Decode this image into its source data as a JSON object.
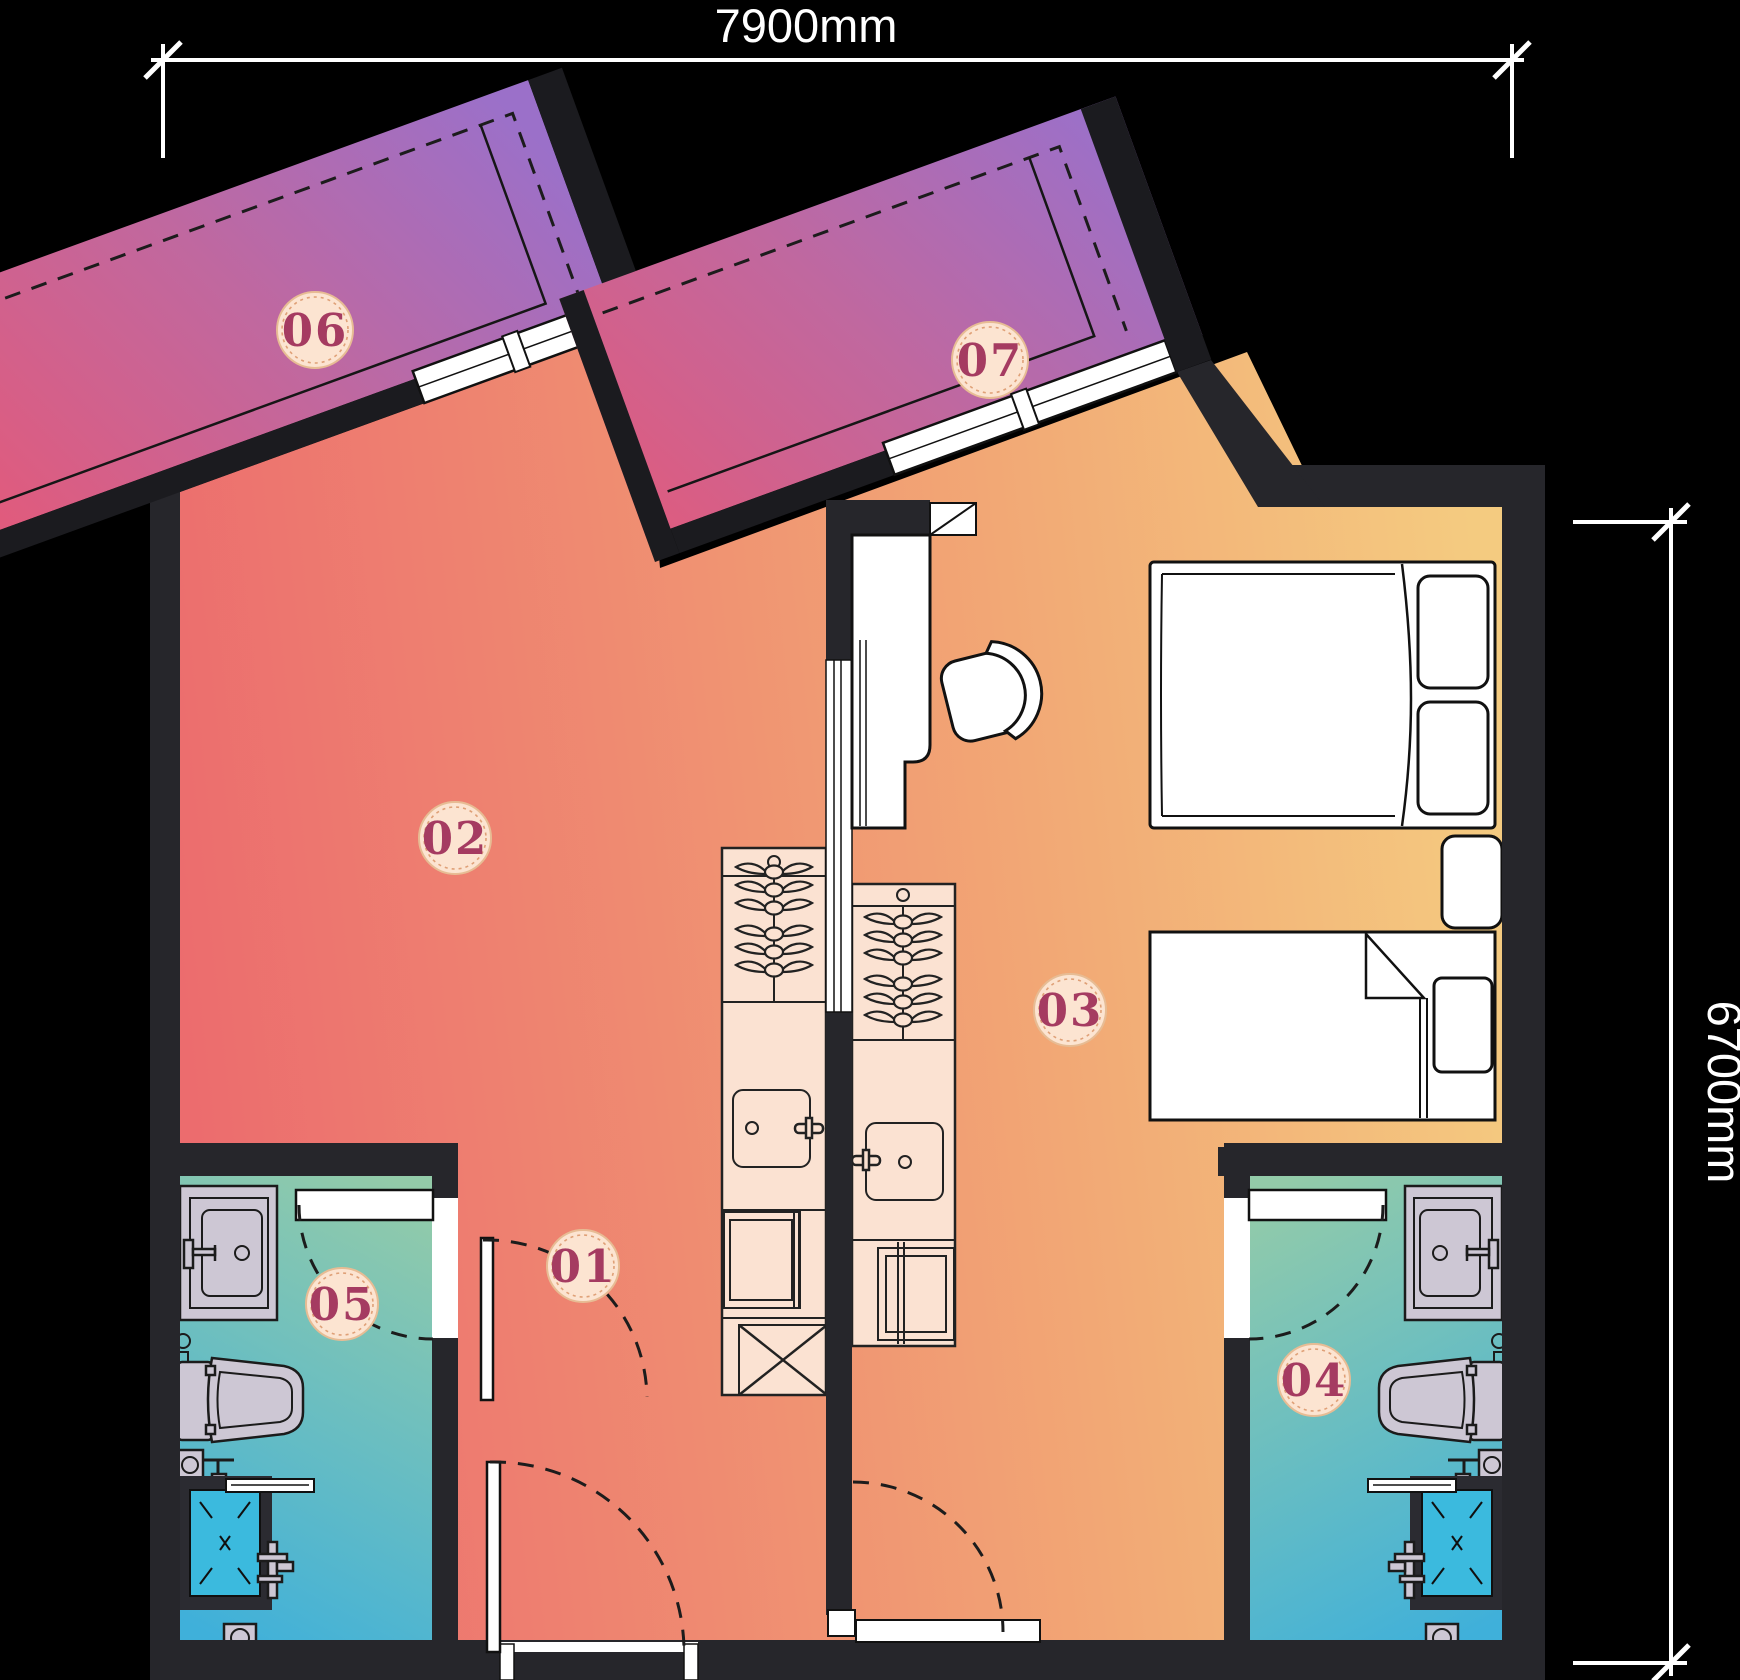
{
  "dimensions": {
    "width_label": "7900mm",
    "height_label": "6700mm"
  },
  "badges": [
    {
      "id": "01",
      "label": "01"
    },
    {
      "id": "02",
      "label": "02"
    },
    {
      "id": "03",
      "label": "03"
    },
    {
      "id": "04",
      "label": "04"
    },
    {
      "id": "05",
      "label": "05"
    },
    {
      "id": "06",
      "label": "06"
    },
    {
      "id": "07",
      "label": "07"
    }
  ],
  "colors": {
    "background": "#000000",
    "wall": "#26262b",
    "floor_warm_left": "#ec6c6e",
    "floor_warm_mid": "#f2a875",
    "floor_warm_right": "#f4cb80",
    "balcony_pink": "#e05b7d",
    "balcony_purple": "#9b70c9",
    "bath_cyan": "#3fb0da",
    "bath_sage": "#93cba9",
    "cabinet_cream": "#fbe2d2",
    "fixture_lavender": "#cdc7d4",
    "shower_cyan": "#3bbade",
    "badge_fill": "#fce4d1",
    "badge_ring": "#dfa077",
    "badge_text": "#a53b61",
    "dimension_text": "#ffffff"
  },
  "fixtures": [
    "balcony-overhang",
    "window",
    "double-bed",
    "single-bed",
    "nightstand",
    "desk",
    "desk-chair",
    "kitchen-counter",
    "drying-rack",
    "kitchen-sink",
    "cooktop",
    "vent-box",
    "vanity-sink",
    "toilet",
    "shower",
    "mixer-tap",
    "floor-drain",
    "door-swing",
    "sliding-panel"
  ]
}
